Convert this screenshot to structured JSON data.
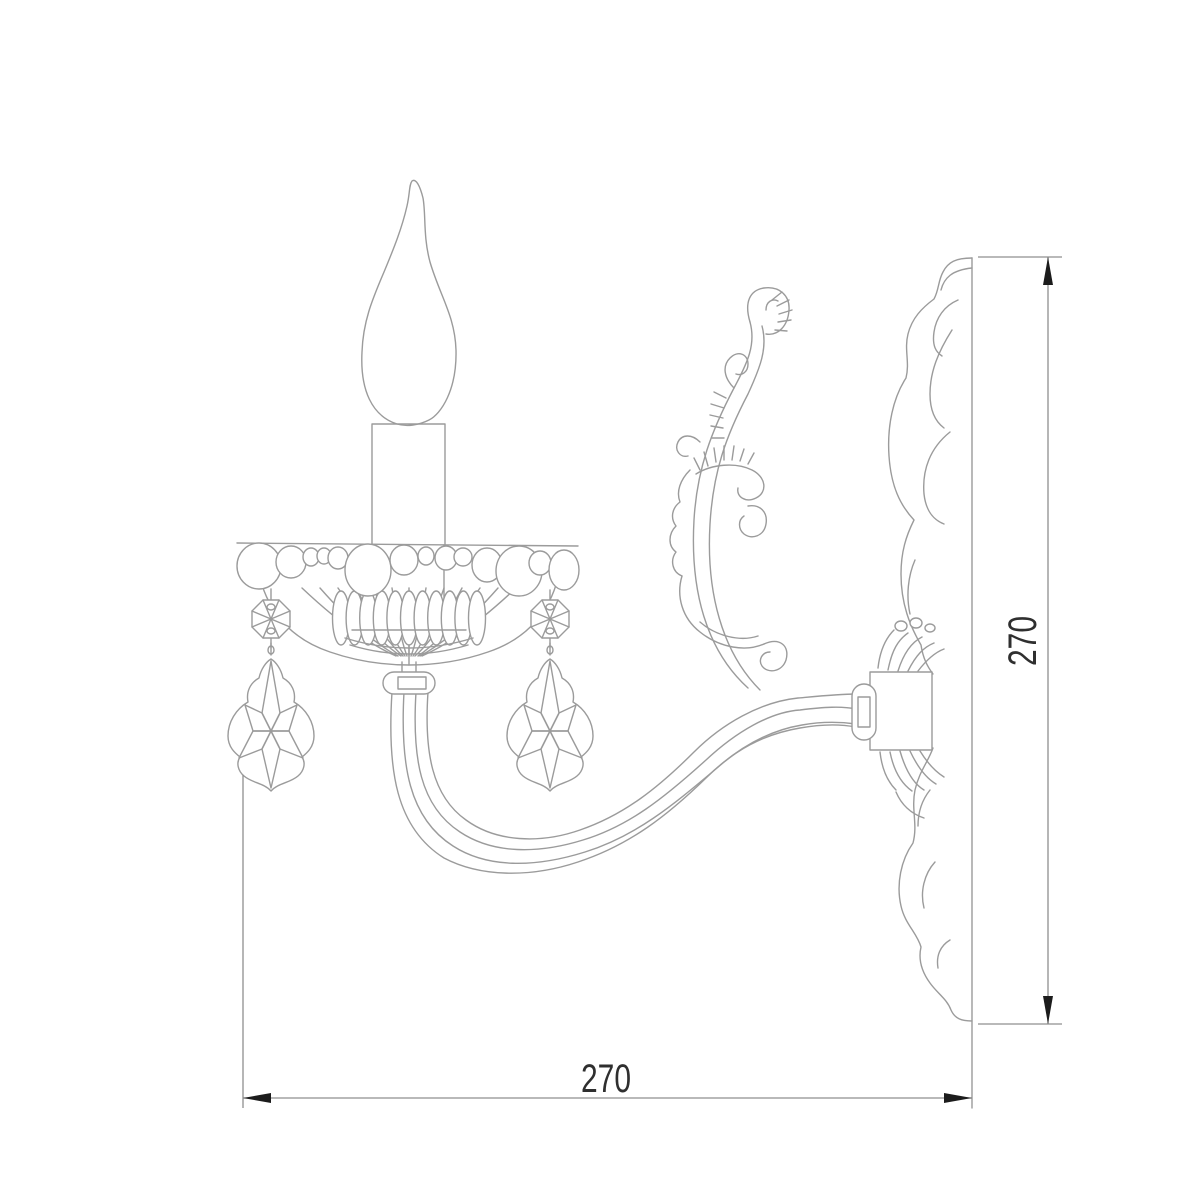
{
  "meta": {
    "drawing_type": "technical line drawing",
    "subject": "classic crystal wall sconce, side elevation with mounting backplate"
  },
  "dimensions": {
    "width": {
      "value": "270"
    },
    "height": {
      "value": "270"
    }
  },
  "components": {
    "flame_bulb": "candle flame shaped bulb",
    "candle_sleeve": "candle tube",
    "bobeche": "beaded drip cup",
    "crystal_octagon_left": "octagon crystal button",
    "crystal_octagon_right": "octagon crystal button",
    "pendant_left": "baroque crystal pendant",
    "pendant_right": "baroque crystal pendant",
    "arm": "curved sconce arm",
    "scroll": "acanthus scroll ornament",
    "backplate": "wall mounting plate profile",
    "bracket": "arm mounting bracket"
  },
  "colors": {
    "background": "#ffffff",
    "line": "#9b9b9b",
    "dimension_line": "#8f8f8f",
    "arrow": "#1c1c1c",
    "text": "#2f2f2f"
  }
}
